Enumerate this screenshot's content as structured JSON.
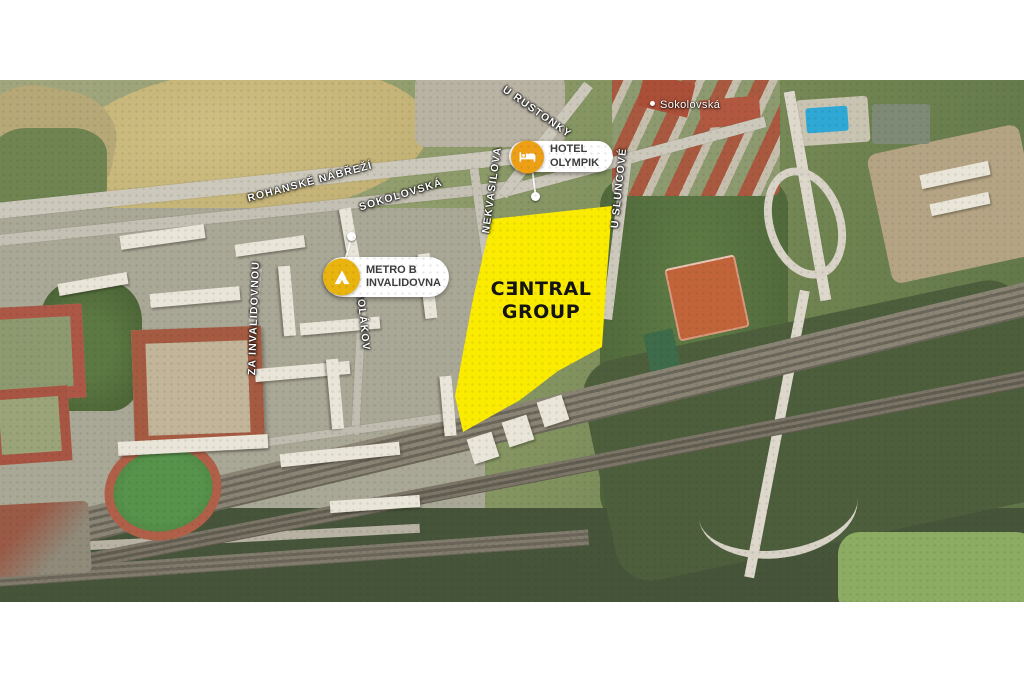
{
  "site": {
    "brand_line1": "CƎNTRAL",
    "brand_line2": "GROUP",
    "fill_color": "#FAEB00",
    "text_color": "#141414"
  },
  "markers": {
    "hotel_olympik": {
      "line1": "HOTEL",
      "line2": "OLYMPIK",
      "badge_color": "#EDA016"
    },
    "metro_invalidovna": {
      "line1": "METRO B",
      "line2": "INVALIDOVNA",
      "badge_color": "#EAB40E"
    }
  },
  "street_labels": {
    "rohanske_nabrezi": "ROHANSKÉ NÁBŘEŽÍ",
    "sokolovska": "SOKOLOVSKÁ",
    "u_rustonky": "U RUSTONKY",
    "nekvasilova": "NEKVASILOVA",
    "u_sluncove": "U SLUNCOVÉ",
    "za_invalidovnou": "ZA INVALIDOVNOU",
    "molakov": "MOLÁKOV",
    "sokolovska_small": "Sokolovská"
  }
}
